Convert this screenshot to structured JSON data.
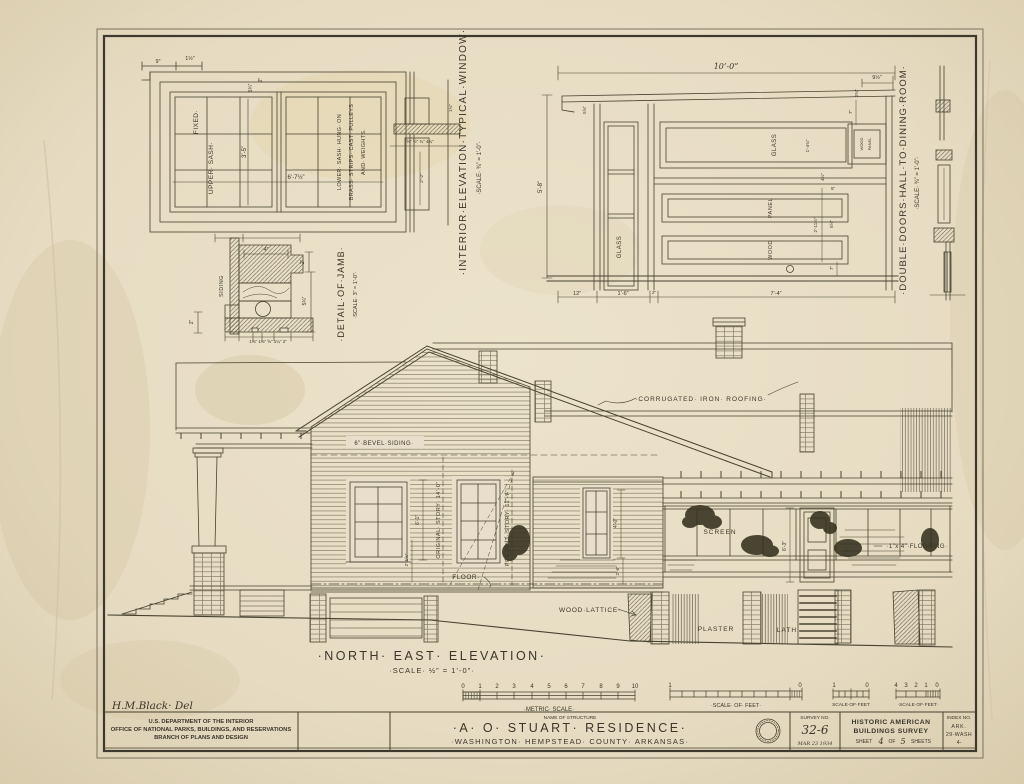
{
  "sheet": {
    "signature": "H.M.Black· Del"
  },
  "window_detail": {
    "title": "·INTERIOR·ELEVATION·TYPICAL·WINDOW·",
    "scale": "·SCALE· ¾” = 1’-0”·",
    "upper_sash": "UPPER· SASH·",
    "fixed": "FIXED·",
    "lower_l1": "LOWER· SASH· HUNG· ON",
    "lower_l2": "BRASS· STRIPS· CAST· PULLEYS",
    "lower_l3": "AND· WEIGHTS.",
    "dim_3_5": "3’-5”",
    "dim_6_7_half": "6’-7½”",
    "dim_9": "9”",
    "dim_1_half": "1½”",
    "dim_2": "2”",
    "dim_5_3_4": "5¾”",
    "dim_row": "⅝” ½” ¾”  4¾”",
    "dim_2_2": "2’-2”",
    "dim_1_3_4": "1¾”"
  },
  "jamb_detail": {
    "title": "·DETAIL·OF·JAMB·",
    "scale": "·SCALE· 3” = 1’-0”·",
    "siding": "SIDING",
    "dim_4": "4”",
    "dim_2_right": "2”",
    "dim_5_1_4": "5¼”",
    "dim_2_left": "2”",
    "dims_bottom": "1⅜”  1⅜”  ⅝” 1¼”   2”"
  },
  "doors_detail": {
    "title": "·DOUBLE·DOORS·HALL·TO·DINING·ROOM·",
    "scale": "·SCALE· ¾” = 1’-0”·",
    "dim_10_0": "10’-0”",
    "dim_5_8": "5’-8”",
    "dim_9_half": "9½”",
    "dim_2_3_4": "2¾”",
    "dim_7_top": "7”",
    "dim_5_5_8": "5⅝”",
    "glass_left": "GLASS",
    "glass_top": "GLASS",
    "dim_1_4_3_4": "1’-4¾”",
    "wood_panel_l1": "WOOD",
    "wood_panel_l2": "PANEL",
    "dim_4_half": "4½”",
    "dim_5": "5”",
    "panel": "PANEL",
    "dim_2_11_half": "2’-11½”",
    "dim_5_half": "5½”",
    "wood": "WOOD",
    "dim_7_bottom": "7”",
    "dim_12": "12”",
    "dim_1_6": "1’-6”",
    "dim_2": "2”",
    "dim_7_4": "7’-4”"
  },
  "elevation": {
    "title": "·NORTH· EAST· ELEVATION·",
    "scale": "·SCALE· ½” = 1’-0”·",
    "roofing": "·CORRUGATED· IRON· ROOFING·",
    "bevel_siding": "6”·BEVEL·SIDING·",
    "original_story": "ORIGINAL· STORY· 14’-0”",
    "present_story": "PRESENT· STORY· 11’-7”",
    "floor": "FLOOR·",
    "dim_6_1": "6’-1”",
    "dim_2_1_5_8": "2’-1⅝”",
    "dim_4_0": "4’-0”",
    "dim_2_6": "2’-6”",
    "dim_6_3": "6’-3”",
    "screen": "SCREEN",
    "flooring": "·1”x 4”·FLOORING·",
    "wood_lattice": "WOOD·LATTICE·",
    "plaster": "PLASTER",
    "lath": "LATH"
  },
  "scales": {
    "metric": {
      "numbers": [
        "0",
        "1",
        "2",
        "3",
        "4",
        "5",
        "6",
        "7",
        "8",
        "9",
        "10"
      ],
      "label": "·METRIC· SCALE·"
    },
    "feet_long": {
      "left": "1",
      "right": "0",
      "label": "·SCALE· OF· FEET·"
    },
    "feet_small": {
      "left": "1",
      "right": "0",
      "label": "SCALE·OF·FEET"
    },
    "feet_right": {
      "numbers": [
        "4",
        "3",
        "2",
        "1",
        "0"
      ],
      "label": "·SCALE·OF·FEET·"
    }
  },
  "title_block": {
    "dept_l1": "U.S. DEPARTMENT OF THE INTERIOR",
    "dept_l2": "OFFICE OF NATIONAL PARKS, BUILDINGS, AND RESERVATIONS",
    "dept_l3": "BRANCH OF PLANS AND DESIGN",
    "name_label": "NAME OF STRUCTURE",
    "structure_name": "·A· O· STUART· RESIDENCE·",
    "structure_location": "·WASHINGTON· HEMPSTEAD· COUNTY· ARKANSAS·",
    "survey_label": "SURVEY NO.",
    "survey_no": "32-6",
    "survey_date": "MAR 23 1934",
    "habs_l1": "HISTORIC AMERICAN",
    "habs_l2": "BUILDINGS SURVEY",
    "sheet_word": "SHEET",
    "sheet_no": "4",
    "of_word": "OF",
    "sheets_total": "5",
    "sheets_word": "SHEETS",
    "index_label": "INDEX NO.",
    "index_l1": "ARK.",
    "index_l2": "29-WASH",
    "index_l3": "4-"
  },
  "colors": {
    "paper": "#e8decb",
    "ink": "#48422f"
  }
}
